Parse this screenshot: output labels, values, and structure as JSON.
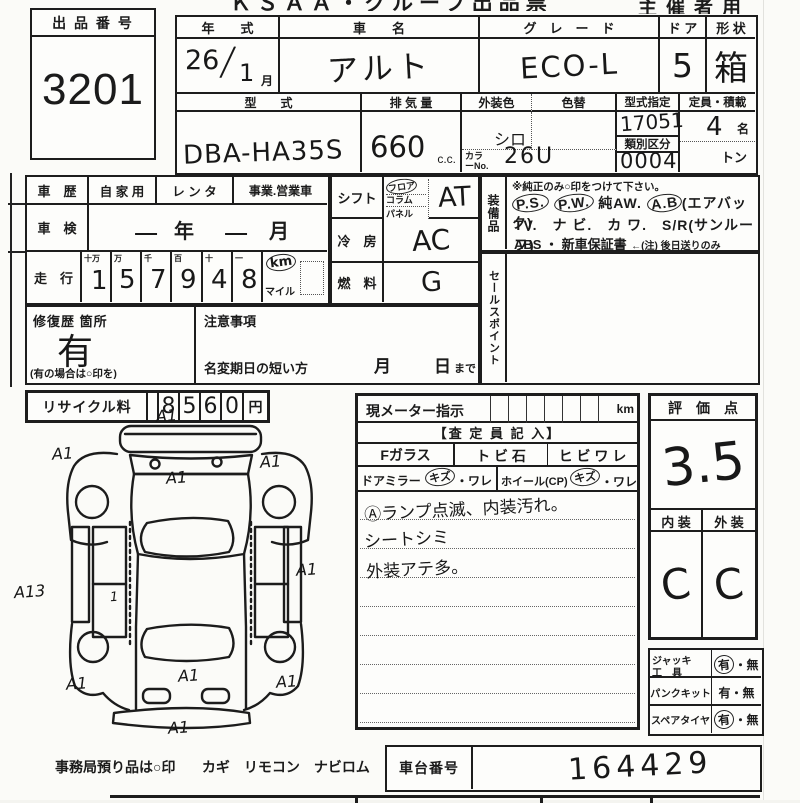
{
  "header": {
    "form_title": "ＫＳＡＡ・グループ出品票",
    "organizer": "主催者用"
  },
  "lot": {
    "label": "出 品 番 号",
    "number": "3201"
  },
  "vehicle": {
    "year_label": "年　　式",
    "year_value": "26",
    "year_slash": "/",
    "year_month": "1",
    "month_suffix": "月",
    "name_label": "車　　名",
    "name_value": "アルト",
    "grade_label": "グ　レ　ー　ド",
    "grade_value": "ECO-L",
    "door_label": "ド ア",
    "door_value": "5",
    "shape_label": "形 状",
    "shape_value": "箱",
    "model_label": "型　　式",
    "model_value": "DBA-HA35S",
    "disp_label": "排 気 量",
    "disp_value": "660",
    "disp_unit": "c.c.",
    "color_label": "外装色",
    "color_value": "シロ",
    "color_change_label": "色替",
    "color_no_label": "カラーNo.",
    "color_no_value": "26U",
    "type_label": "型式指定",
    "type_value": "17051",
    "class_label": "類別区分",
    "class_value": "0004",
    "cap_label": "定員・積載",
    "cap_value": "4",
    "cap_unit": "名",
    "load_unit": "トン"
  },
  "history": {
    "label": "車　歴",
    "opt1": "自 家 用",
    "opt2": "レ ン タ",
    "opt3": "事業.営業車"
  },
  "shaken": {
    "label": "車　検",
    "v1": "一",
    "year_unit": "年",
    "v2": "一",
    "month_unit": "月"
  },
  "mileage": {
    "label": "走　行",
    "cols": [
      "十万",
      "万",
      "千",
      "百",
      "十",
      "一"
    ],
    "digits": [
      "1",
      "5",
      "7",
      "9",
      "4",
      "8"
    ],
    "km": "km",
    "mile": "マイル"
  },
  "shift": {
    "label": "シフト",
    "opts": [
      "フロア",
      "コラム",
      "パネル"
    ],
    "value": "AT"
  },
  "ac": {
    "label": "冷　房",
    "value": "AC"
  },
  "fuel": {
    "label": "燃　料",
    "value": "G"
  },
  "equip": {
    "label": "装備品",
    "note": "※純正のみ○印をつけて下さい。",
    "t1": "P.S.",
    "t2": "P.W.",
    "t3": "純AW.",
    "t4": "A.B",
    "t5": "(エアバック)",
    "line2": "TV.　ナ ビ.　カ ワ.　S/R(サンルーフ)",
    "line3a": "ABS ・ 新車保証書",
    "line3b": "←(注) 後日送りのみ"
  },
  "sales": {
    "label": "セールスポイント"
  },
  "repair": {
    "label": "修復歴 箇所",
    "value": "有",
    "note": "(有の場合は○印を)"
  },
  "notice": {
    "label": "注意事項",
    "transfer": "名変期日の短い方",
    "month": "月",
    "day": "日",
    "made": "まで"
  },
  "recycle": {
    "label": "リサイクル料",
    "digits": [
      "8",
      "5",
      "6",
      "0"
    ],
    "unit": "円"
  },
  "meter": {
    "label": "現メーター指示",
    "unit": "km",
    "assessor": "【査 定 員 記 入】",
    "glass": "Fガラス",
    "stone": "ト ビ 石",
    "crack": "ヒ ビ ワ レ",
    "mirror": "ドアミラー",
    "kizu1": "キズ",
    "ware1": "・ワレ",
    "wheel": "ホイール(CP)",
    "kizu2": "キズ",
    "ware2": "・ワレ",
    "notes": [
      "Ⓐランプ点滅、内装汚れ。",
      "シートシミ",
      "外装アテ多。"
    ]
  },
  "score": {
    "label": "評　価　点",
    "value": "3.5",
    "int_label": "内 装",
    "ext_label": "外 装",
    "int_value": "C",
    "ext_value": "C"
  },
  "acc": {
    "rows": [
      {
        "label": "ジャッキ",
        "label2": "工　具",
        "yes": "有",
        "no": "無"
      },
      {
        "label": "パンクキット",
        "label2": "",
        "yes": "有",
        "no": "無"
      },
      {
        "label": "スペアタイヤ",
        "label2": "",
        "yes": "有",
        "no": "無"
      }
    ]
  },
  "chassis": {
    "label": "車台番号",
    "value": "164429"
  },
  "office": {
    "note": "事務局預り品は○印",
    "items": "カギ　リモコン　ナビロム"
  },
  "car_diagram": {
    "annotations": [
      {
        "label": "A1"
      },
      {
        "label": "A1"
      },
      {
        "label": "A1"
      },
      {
        "label": "A1"
      },
      {
        "label": "A1"
      },
      {
        "label": "A13"
      },
      {
        "label": "1"
      },
      {
        "label": "A1"
      },
      {
        "label": "A1"
      },
      {
        "label": "A1"
      },
      {
        "label": "A1"
      }
    ]
  }
}
